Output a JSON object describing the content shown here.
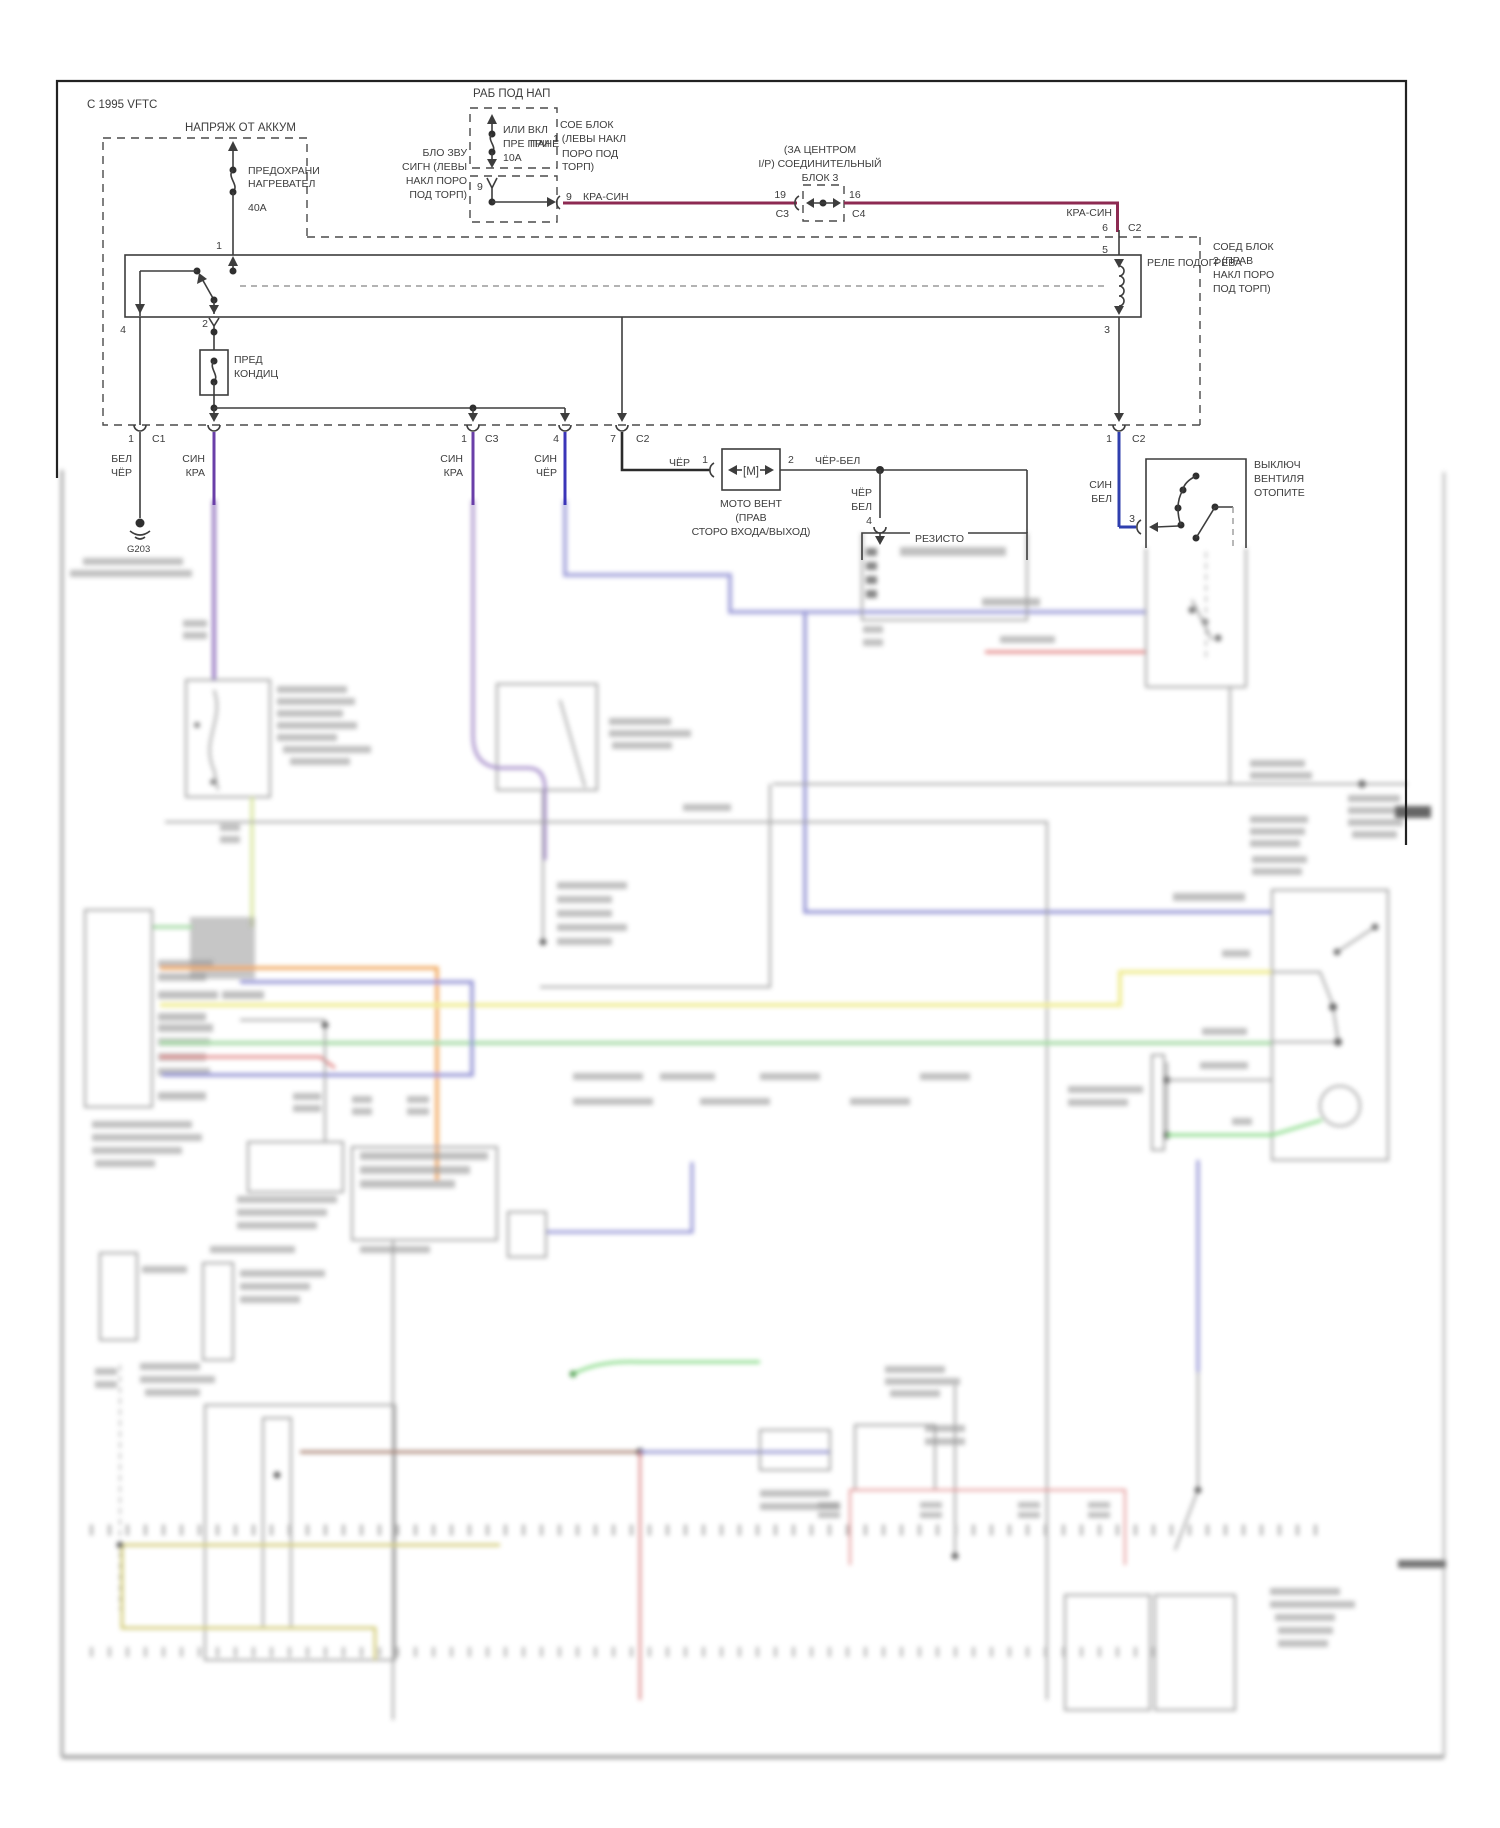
{
  "page": {
    "header": "С 1995 VFTC"
  },
  "colors": {
    "kra_sin": "#8d2a52",
    "sin_kra": "#6a3fa8",
    "sin_cher": "#3b35b8",
    "sin_bel": "#2f3fae",
    "cher": "#2b2b2b",
    "blur_lavender": "#9b9bd8",
    "blur_yellow": "#eeea86",
    "blur_green": "#9fd89f",
    "blur_bright_green": "#7cd87c",
    "blur_orange": "#f0a050",
    "blur_red": "#e07878",
    "blur_olive": "#cfc870",
    "blur_brown": "#a07868"
  },
  "labels": {
    "batt": "НАПРЯЖ ОТ АККУМ",
    "fuse40": [
      "ПРЕДОХРАНИ",
      "НАГРЕВАТЕЛ",
      "40А"
    ],
    "runnap": "РАБ ПОД НАП",
    "fuse10": [
      "ИЛИ ВКЛ",
      "ПРЕ ПРИ",
      "10А"
    ],
    "pane": "ПАНЕ",
    "junc1": [
      "СОЕ БЛОК",
      "1 (ЛЕВЫ НАКЛ",
      "ПОРО ПОД",
      "ТОРП)"
    ],
    "horn": [
      "БЛО ЗВУ",
      "СИГН (ЛЕВЫ",
      "НАКЛ ПОРО",
      "ПОД ТОРП)"
    ],
    "jb3": [
      "(ЗА ЦЕНТРОМ",
      "I/P) СОЕДИНИТЕЛЬНЫЙ",
      "БЛОК 3"
    ],
    "jb2": [
      "СОЕД БЛОК",
      "2 (ПРАВ",
      "НАКЛ ПОРО",
      "ПОД ТОРП)"
    ],
    "relay": "РЕЛЕ ПОДОГРЕВА",
    "predcond": [
      "ПРЕД",
      "КОНДИЦ"
    ],
    "motor": [
      "МОТО ВЕНТ",
      "(ПРАВ",
      "СТОРО ВХОДА/ВЫХОД)"
    ],
    "motor_sym": "[М]",
    "resistor": "РЕЗИСТО",
    "fanswitch": [
      "ВЫКЛЮЧ",
      "ВЕНТИЛЯ",
      "ОТОПИТЕ"
    ],
    "ground": "G203"
  },
  "wires": {
    "krasin_a": "КРА-СИН",
    "krasin_b": "КРА-СИН",
    "belcher": [
      "БЕЛ",
      "ЧЁР"
    ],
    "sinkra_a": [
      "СИН",
      "КРА"
    ],
    "sinkra_b": [
      "СИН",
      "КРА"
    ],
    "sincher": [
      "СИН",
      "ЧЁР"
    ],
    "cher": "ЧЁР",
    "cherbel": "ЧЁР-БЕЛ",
    "cherbel_v": [
      "ЧЁР",
      "БЕЛ"
    ],
    "sinbel": [
      "СИН",
      "БЕЛ"
    ]
  },
  "pins": {
    "fuse1": "1",
    "r4": "4",
    "r2": "2",
    "r5": "5",
    "r3": "3",
    "p9_in": "9",
    "p9_w": "9",
    "p19": "19",
    "c3a": "C3",
    "p16": "16",
    "c4": "C4",
    "p6": "6",
    "c2a": "C2",
    "p5": "5",
    "p1c1_n": "1",
    "p1c1_c": "C1",
    "p1c3_n": "1",
    "p1c3_c": "C3",
    "p4b": "4",
    "p7": "7",
    "c2b": "C2",
    "m1": "1",
    "m2": "2",
    "res4": "4",
    "p1c2_n": "1",
    "c2c": "C2",
    "sw3": "3"
  }
}
